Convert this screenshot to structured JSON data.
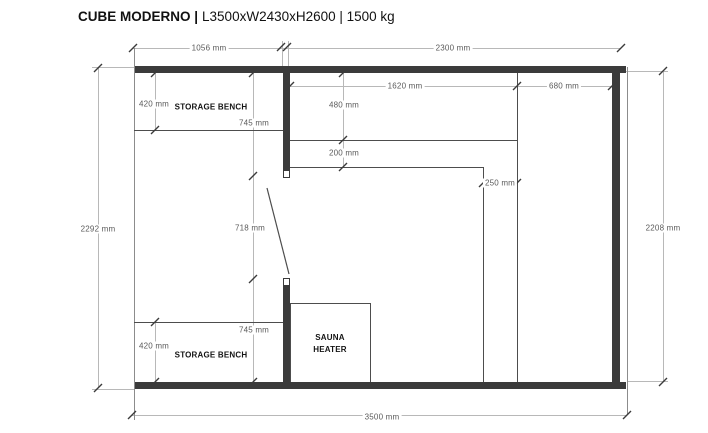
{
  "title": {
    "product": "CUBE MODERNO |",
    "specs": "L3500xW2430xH2600 | 1500 kg"
  },
  "plan": {
    "benches": {
      "top": "STORAGE BENCH",
      "bottom": "STORAGE BENCH"
    },
    "heater": {
      "line1": "SAUNA",
      "line2": "HEATER"
    },
    "dims": {
      "top_left_width": "1056 mm",
      "top_right_width": "2300 mm",
      "left_height": "2292 mm",
      "right_height": "2208 mm",
      "total_width": "3500 mm",
      "bench_top_depth": "420 mm",
      "wall_top_segment": "745 mm",
      "door_opening": "718 mm",
      "wall_bottom_segment": "745 mm",
      "bench_bottom_depth": "420 mm",
      "sauna_bench_depth": "480 mm",
      "step_depth": "200 mm",
      "sauna_inner_width": "1620 mm",
      "sauna_right_width": "680 mm",
      "ledge_width": "250 mm"
    },
    "colors": {
      "wall": "#3b3b3b",
      "line": "#4d4d4d",
      "dim": "#b8b8b8"
    }
  }
}
